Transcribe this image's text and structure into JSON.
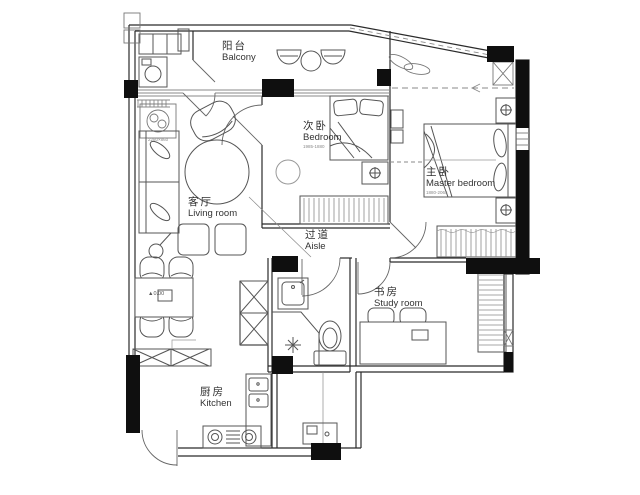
{
  "colors": {
    "background": "#ffffff",
    "wall_fill": "#0f0f0f",
    "wall_line": "#2b2b2b",
    "furniture_line": "#555555",
    "light_line": "#8a8a8a"
  },
  "rooms": {
    "balcony": {
      "zh": "阳台",
      "en": "Balcony"
    },
    "bedroom": {
      "zh": "次卧",
      "en": "Bedroom",
      "dim": "1985-1880"
    },
    "master_bedroom": {
      "zh": "主卧",
      "en": "Master bedroom",
      "dim": "1880-2065"
    },
    "living_room": {
      "zh": "客厅",
      "en": "Living room"
    },
    "aisle": {
      "zh": "过道",
      "en": "Aisle"
    },
    "study_room": {
      "zh": "书房",
      "en": "Study room"
    },
    "kitchen": {
      "zh": "厨房",
      "en": "Kitchen"
    }
  },
  "annotations": {
    "sofa_dim": "2280×860",
    "level_marker": "▲0.00"
  }
}
